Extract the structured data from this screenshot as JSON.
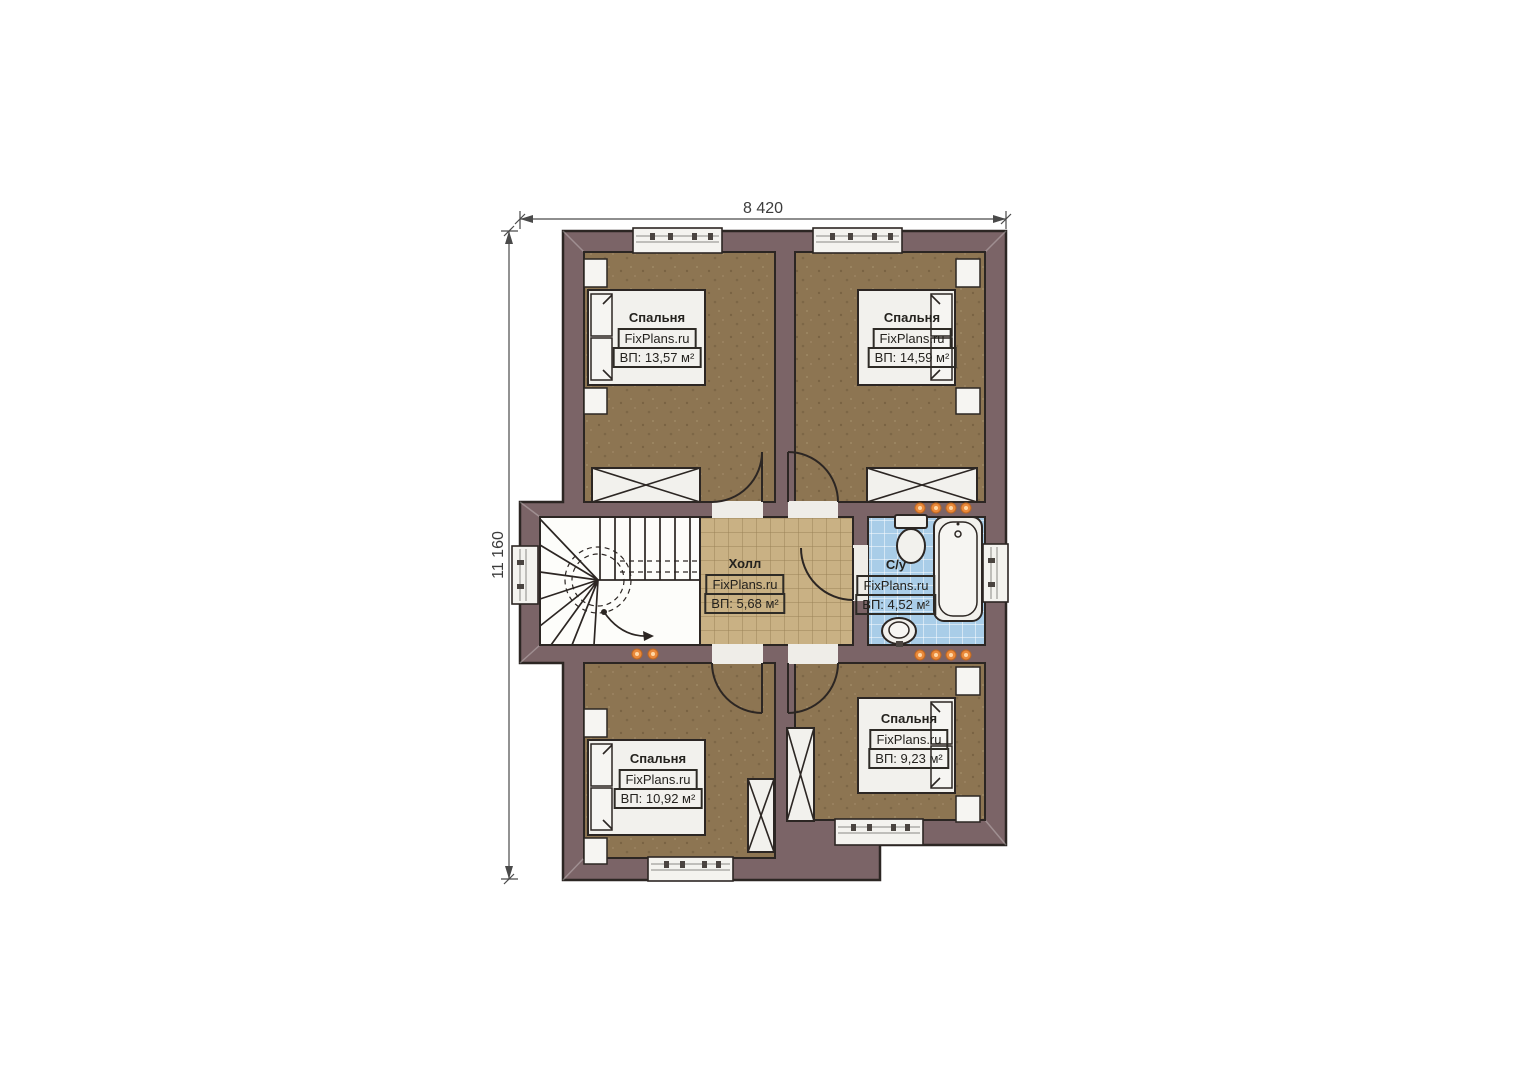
{
  "dimensions": {
    "top": "8 420",
    "left": "11 160"
  },
  "rooms": {
    "bedroom_top_left": {
      "title": "Спальня",
      "brand": "FixPlans.ru",
      "area": "ВП: 13,57 м²"
    },
    "bedroom_top_right": {
      "title": "Спальня",
      "brand": "FixPlans.ru",
      "area": "ВП: 14,59 м²"
    },
    "hall": {
      "title": "Холл",
      "brand": "FixPlans.ru",
      "area": "ВП: 5,68 м²"
    },
    "bathroom": {
      "title": "С/у",
      "brand": "FixPlans.ru",
      "area": "ВП: 4,52 м²"
    },
    "bedroom_bottom_left": {
      "title": "Спальня",
      "brand": "FixPlans.ru",
      "area": "ВП: 10,92 м²"
    },
    "bedroom_bottom_right": {
      "title": "Спальня",
      "brand": "FixPlans.ru",
      "area": "ВП: 9,23 м²"
    }
  },
  "colors": {
    "wall": "#7b6467",
    "bedroom_floor": "#8d7552",
    "hall_floor": "#c9b184",
    "bath_floor": "#a9cde8",
    "fixture": "#f2f1ed",
    "outline": "#2c2623",
    "spotlight": "#ea8a3c"
  }
}
